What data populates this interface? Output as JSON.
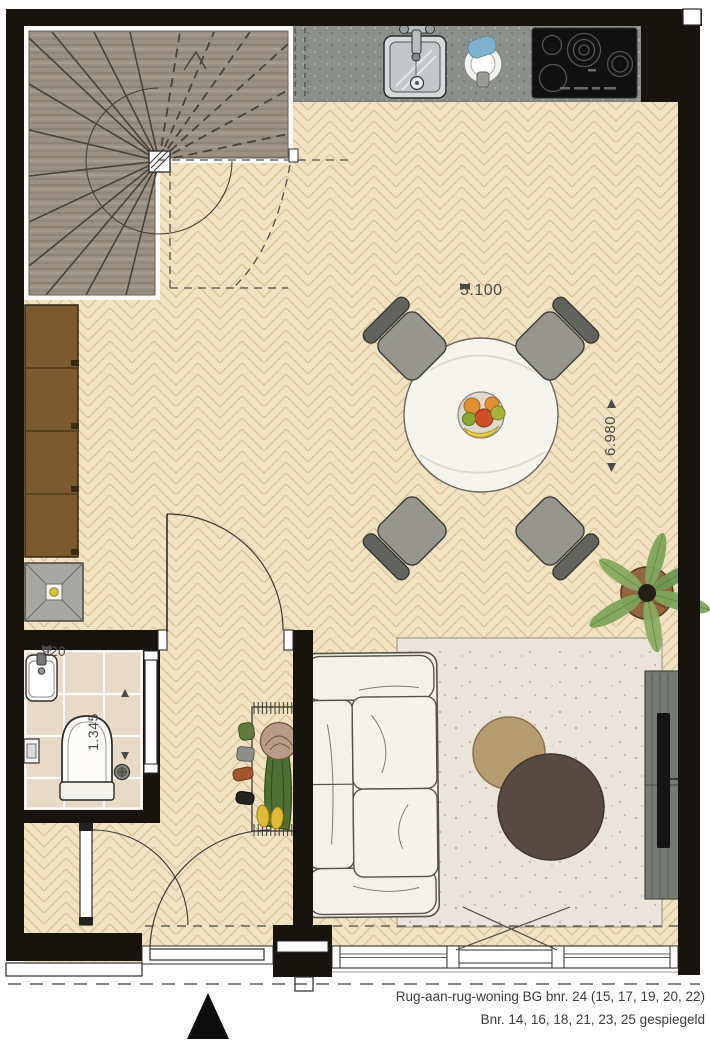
{
  "drawing": {
    "type_label": "floor-plan",
    "caption": {
      "line1": "Rug-aan-rug-woning BG bnr. 24 (15, 17, 19, 20, 22)",
      "line2": "Bnr. 14, 16, 18, 21, 23, 25 gespiegeld"
    }
  },
  "dimensions": {
    "living_width": "5.100",
    "living_depth": "6.980",
    "toilet_width": "920",
    "toilet_depth": "1.345"
  },
  "rooms": {
    "living_kitchen": "woonkamer/keuken",
    "toilet": "toilet",
    "hall": "hal",
    "meter_cupboard": "meterkast",
    "stairs": "trap"
  },
  "elements": [
    "spiral-staircase",
    "kitchen-counter",
    "kitchen-sink",
    "kitchen-faucet",
    "kettle",
    "cooktop",
    "dining-table",
    "dining-chair",
    "fruit-bowl",
    "wardrobe-cabinet",
    "side-table",
    "coat-rack",
    "toilet-bowl",
    "hand-basin",
    "floor-drain",
    "sofa",
    "rug",
    "coffee-table-small",
    "coffee-table-large",
    "tv-cabinet",
    "tv",
    "plant",
    "north-arrow",
    "entrance-door",
    "window"
  ],
  "colors": {
    "wall": "#17130f",
    "floor_wood": "#f1e2c2",
    "floor_wood_line": "#d9c096",
    "stair_wood": "#9c9083",
    "counter": "#8b8f89",
    "cabinet_brown": "#7c5a2f",
    "rug": "#ebe4db",
    "table_tan": "#b69b6e",
    "table_dark": "#584a40",
    "plant_green": "#7ea45b",
    "dim_text": "#4a4a4a"
  }
}
